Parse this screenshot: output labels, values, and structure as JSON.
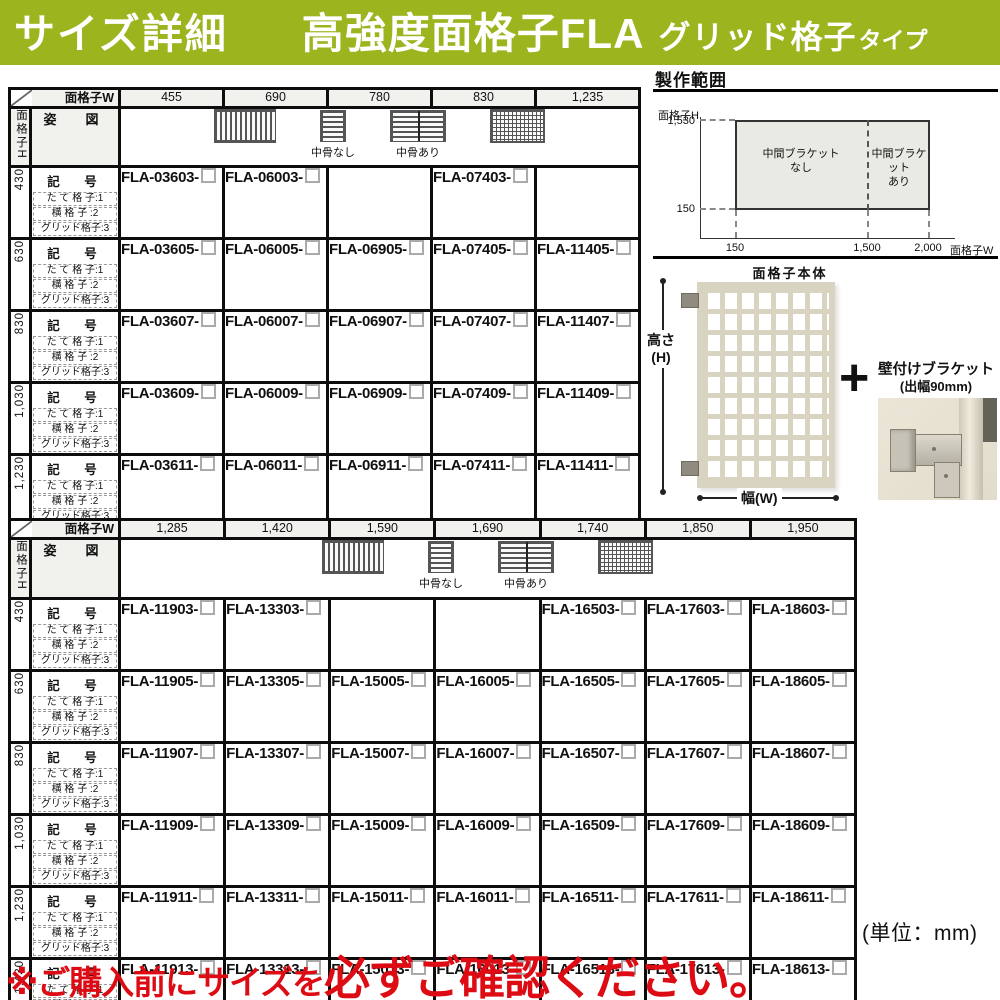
{
  "header": {
    "title_left": "サイズ詳細",
    "title_main": "高強度面格子FLA",
    "title_sub": "グリッド格子",
    "title_sub_small": "タイプ"
  },
  "tables": [
    {
      "corner_label": "面格子W",
      "side_label": "面格子H",
      "figure_row_label": "姿　図",
      "figure_labels": {
        "no_midrib": "中骨なし",
        "with_midrib": "中骨あり"
      },
      "figure_types": [
        "vertical-lattice",
        "horizontal-lattice-no-midrib",
        "horizontal-lattice-with-midrib",
        "grid-lattice"
      ],
      "row_header": {
        "kigo": "記　号",
        "types": [
          "た て 格 子:1",
          "横  格  子 :2",
          "グリッド格子:3"
        ]
      },
      "widths": [
        "455",
        "690",
        "780",
        "830",
        "1,235"
      ],
      "heights": [
        "430",
        "630",
        "830",
        "1,030",
        "1,230",
        "1,430"
      ],
      "codes": [
        [
          "FLA-03603-",
          "FLA-06003-",
          null,
          "FLA-07403-",
          null
        ],
        [
          "FLA-03605-",
          "FLA-06005-",
          "FLA-06905-",
          "FLA-07405-",
          "FLA-11405-"
        ],
        [
          "FLA-03607-",
          "FLA-06007-",
          "FLA-06907-",
          "FLA-07407-",
          "FLA-11407-"
        ],
        [
          "FLA-03609-",
          "FLA-06009-",
          "FLA-06909-",
          "FLA-07409-",
          "FLA-11409-"
        ],
        [
          "FLA-03611-",
          "FLA-06011-",
          "FLA-06911-",
          "FLA-07411-",
          "FLA-11411-"
        ],
        [
          "FLA-03613-",
          "FLA-06013-",
          "FLA-06913-",
          "FLA-07413-",
          "FLA-11413-"
        ]
      ]
    },
    {
      "corner_label": "面格子W",
      "side_label": "面格子H",
      "figure_row_label": "姿　図",
      "figure_labels": {
        "no_midrib": "中骨なし",
        "with_midrib": "中骨あり"
      },
      "figure_types": [
        "vertical-lattice",
        "horizontal-lattice-no-midrib",
        "horizontal-lattice-with-midrib",
        "grid-lattice"
      ],
      "row_header": {
        "kigo": "記　号",
        "types": [
          "た て 格 子:1",
          "横  格  子 :2",
          "グリッド格子:3"
        ]
      },
      "widths": [
        "1,285",
        "1,420",
        "1,590",
        "1,690",
        "1,740",
        "1,850",
        "1,950"
      ],
      "heights": [
        "430",
        "630",
        "830",
        "1,030",
        "1,230",
        "1,430"
      ],
      "codes": [
        [
          "FLA-11903-",
          "FLA-13303-",
          null,
          null,
          "FLA-16503-",
          "FLA-17603-",
          "FLA-18603-"
        ],
        [
          "FLA-11905-",
          "FLA-13305-",
          "FLA-15005-",
          "FLA-16005-",
          "FLA-16505-",
          "FLA-17605-",
          "FLA-18605-"
        ],
        [
          "FLA-11907-",
          "FLA-13307-",
          "FLA-15007-",
          "FLA-16007-",
          "FLA-16507-",
          "FLA-17607-",
          "FLA-18607-"
        ],
        [
          "FLA-11909-",
          "FLA-13309-",
          "FLA-15009-",
          "FLA-16009-",
          "FLA-16509-",
          "FLA-17609-",
          "FLA-18609-"
        ],
        [
          "FLA-11911-",
          "FLA-13311-",
          "FLA-15011-",
          "FLA-16011-",
          "FLA-16511-",
          "FLA-17611-",
          "FLA-18611-"
        ],
        [
          "FLA-11913-",
          "FLA-13313-",
          "FLA-15013-",
          "FLA-16013-",
          "FLA-16513-",
          "FLA-17613-",
          "FLA-18613-"
        ]
      ]
    }
  ],
  "production_range": {
    "title": "製作範囲",
    "y_axis_label": "面格子H",
    "y_max": "1,530",
    "y_min": "150",
    "x_ticks": [
      "150",
      "1,500",
      "2,000"
    ],
    "x_axis_label": "面格子W",
    "zone_left_line1": "中間ブラケット",
    "zone_left_line2": "なし",
    "zone_right_line1": "中間ブラケット",
    "zone_right_line2": "あり"
  },
  "product": {
    "body_label": "面格子本体",
    "height_label": "高さ",
    "height_sub": "(H)",
    "width_label": "幅(W)",
    "plus": "+",
    "bracket_title": "壁付けブラケット",
    "bracket_sub": "(出幅90mm)"
  },
  "unit_note": "(単位：mm)",
  "warning": {
    "prefix": "※ご購入前にサイズを",
    "emphasis": "必ずご確認ください。"
  },
  "colors": {
    "accent_green": "#9cb51e",
    "warning_red": "#dd0b13",
    "header_cell_gray": "#f1f1ee",
    "range_fill_gray": "#eaeae5"
  }
}
